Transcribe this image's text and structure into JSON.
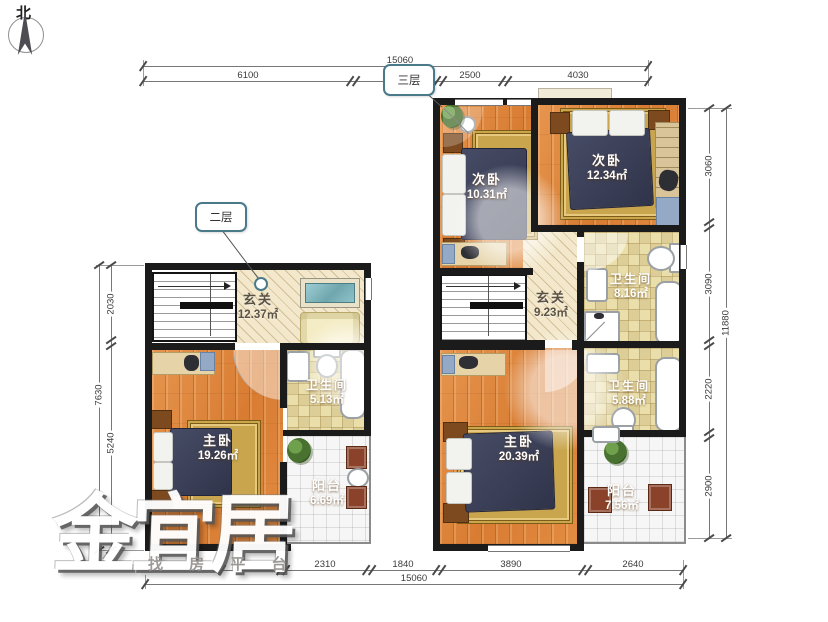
{
  "compass": {
    "label": "北"
  },
  "callouts": {
    "floor2": "二层",
    "floor3": "三层"
  },
  "watermark": {
    "brand": "金宜居",
    "tagline": "找 房 平 台"
  },
  "colors": {
    "wall": "#1b1b1b",
    "wood_floor": "#dc8840",
    "bath_tile": "#eadfab",
    "entry_hatch": "#f3e8cb",
    "balcony_tile": "#f6f6f6",
    "bed": "#3b3f55",
    "rug": "#c9a64e",
    "callout_accent": "#4a7a8a"
  },
  "dimensions": {
    "top": {
      "total": "15060",
      "seg1": "6100",
      "seg2": "2500",
      "seg3": "4030"
    },
    "bottom": {
      "total": "15060",
      "seg1": "2310",
      "seg2": "1840",
      "seg3": "3890",
      "seg4": "2640"
    },
    "left": {
      "total": "7630",
      "seg1": "2030",
      "seg2": "5240"
    },
    "right": {
      "total": "11880",
      "seg1": "3060",
      "seg2": "3090",
      "seg3": "2220",
      "seg4": "2900"
    }
  },
  "floor2": {
    "entry": {
      "name": "玄关",
      "area": "12.37㎡"
    },
    "master": {
      "name": "主卧",
      "area": "19.26㎡"
    },
    "bath": {
      "name": "卫生间",
      "area": "5.13㎡"
    },
    "balcony": {
      "name": "阳台",
      "area": "6.69㎡"
    }
  },
  "floor3": {
    "bedroom1": {
      "name": "次卧",
      "area": "10.31㎡"
    },
    "bedroom2": {
      "name": "次卧",
      "area": "12.34㎡"
    },
    "entry": {
      "name": "玄关",
      "area": "9.23㎡"
    },
    "bath1": {
      "name": "卫生间",
      "area": "8.16㎡"
    },
    "bath2": {
      "name": "卫生间",
      "area": "5.88㎡"
    },
    "master": {
      "name": "主卧",
      "area": "20.39㎡"
    },
    "balcony": {
      "name": "阳台",
      "area": "7.56㎡"
    }
  }
}
